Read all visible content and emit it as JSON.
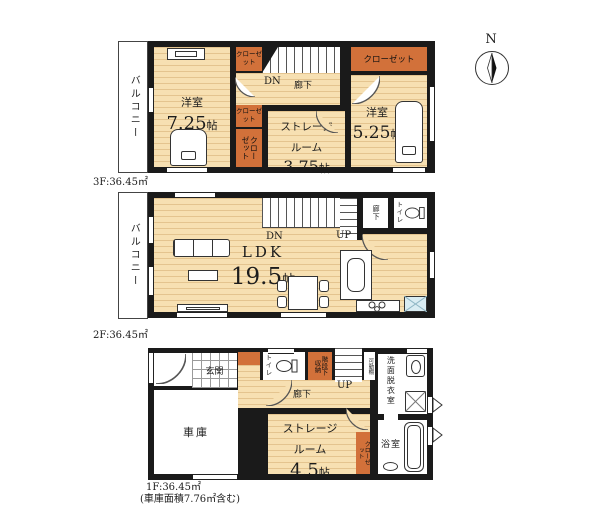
{
  "colors": {
    "wall": "#1a1a1a",
    "floor_cream": "#f7e0b2",
    "closet_orange": "#d2713a",
    "tile_blue": "#d9ecf2"
  },
  "compass": {
    "label": "N"
  },
  "floors": {
    "f3": {
      "area": "3F:36.45㎡",
      "balcony": "バルコニー",
      "hall": "廊下",
      "dn": "DN",
      "bedroom1": {
        "name": "洋室",
        "num": "7.25",
        "unit": "帖"
      },
      "bedroom2": {
        "name": "洋室",
        "num": "5.25",
        "unit": "帖"
      },
      "storage": {
        "line1": "ストレージ",
        "line2": "ルーム",
        "num": "3.75",
        "unit": "帖"
      },
      "closet_a": "クローゼット",
      "closet_b": "クローゼット",
      "closet_c": "クローゼット",
      "closet_top": "クローゼット"
    },
    "f2": {
      "area": "2F:36.45㎡",
      "balcony": "バルコニー",
      "dn": "DN",
      "up": "UP",
      "hall": "廊下",
      "toilet": "トイレ",
      "ldk": {
        "name": "LDK",
        "num": "19.5",
        "unit": "帖"
      }
    },
    "f1": {
      "area": "1F:36.45㎡",
      "area_note": "(車庫面積7.76㎡含む)",
      "entrance": "玄関",
      "toilet": "トイレ",
      "understairs": "階段下収納",
      "up": "UP",
      "shelf": "可動棚",
      "washroom": "洗面脱衣室",
      "hall": "廊下",
      "garage": "車庫",
      "bath": "浴室",
      "storage": {
        "line1": "ストレージ",
        "line2": "ルーム",
        "num": "4.5",
        "unit": "帖"
      },
      "closet": "クローゼット"
    }
  }
}
